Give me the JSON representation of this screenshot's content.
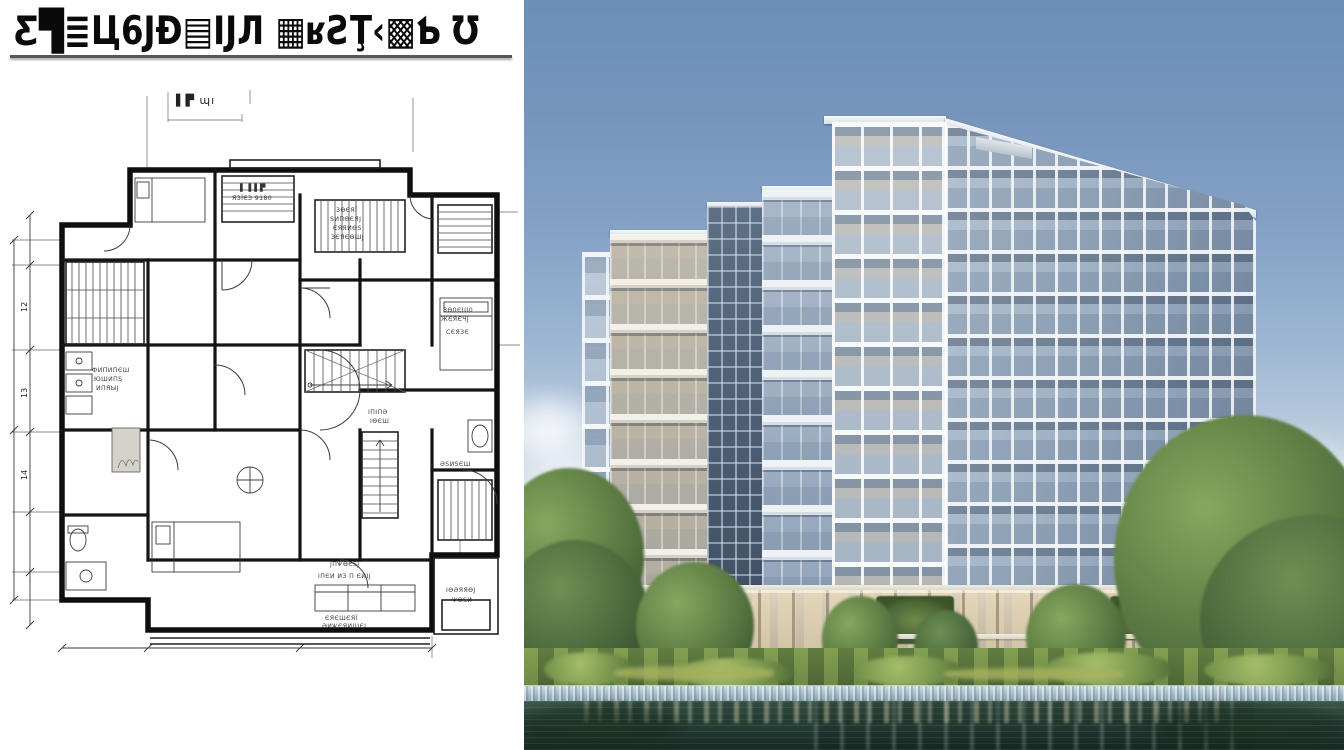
{
  "plan": {
    "title": "Ƹ▜≣Ц6ЈƉ▤ĲЛ ▦ʁƧŢ‹▩Ƅ Ʊ",
    "corner_label": "▌▛ ɰı",
    "dims_left": [
      "12",
      "13",
      "14"
    ],
    "labels": {
      "top_room": [
        "ЗѲЄЯЇ",
        "ЅИПѲЄЯЈ",
        "ЄЯЯИѲЅ",
        "ЗЄЯЄѲШЈ"
      ],
      "top_center": [
        "▌▐ ▌▛",
        "ЯЗЇЄЗ 9180"
      ],
      "right_room": [
        "ЗѲ0ЄШ0",
        "ЖЄЯЄЧЈ",
        "СЄЯЗЄ"
      ],
      "left_room": [
        "ФИПИПЄШ",
        "ЮШИПЅ",
        "ИПЯЫЈ"
      ],
      "bottom_room": [
        "ІПЄИ ИЗ П ЄИІЈ",
        "ЄЯЄШЄЯЇ",
        "ӘИѰЄЯИШЄЈ",
        "ЈПѰѲЄЅЈ"
      ],
      "bottom_right_room": [
        "ІѲӘЯЯѲЈ",
        "ѰѲЅИ"
      ],
      "stair_note": [
        "ІПІПӘ",
        "ІѲЄШ"
      ],
      "closet_note": "ӘЅИЅЄШ"
    }
  },
  "photo": {
    "colors": {
      "sky_top": "#6a8fb8",
      "sky_horizon": "#eef2f3",
      "facade_white": "#eff2f5",
      "facade_warm": "#d8d1c3",
      "glass_dark": "#47586e",
      "tree_green": "#4c6636",
      "hedge_green": "#5b783c",
      "stone_edge": "#9fb7c4",
      "water_deep": "#172a21",
      "podium_beige": "#cdc2ac"
    }
  }
}
